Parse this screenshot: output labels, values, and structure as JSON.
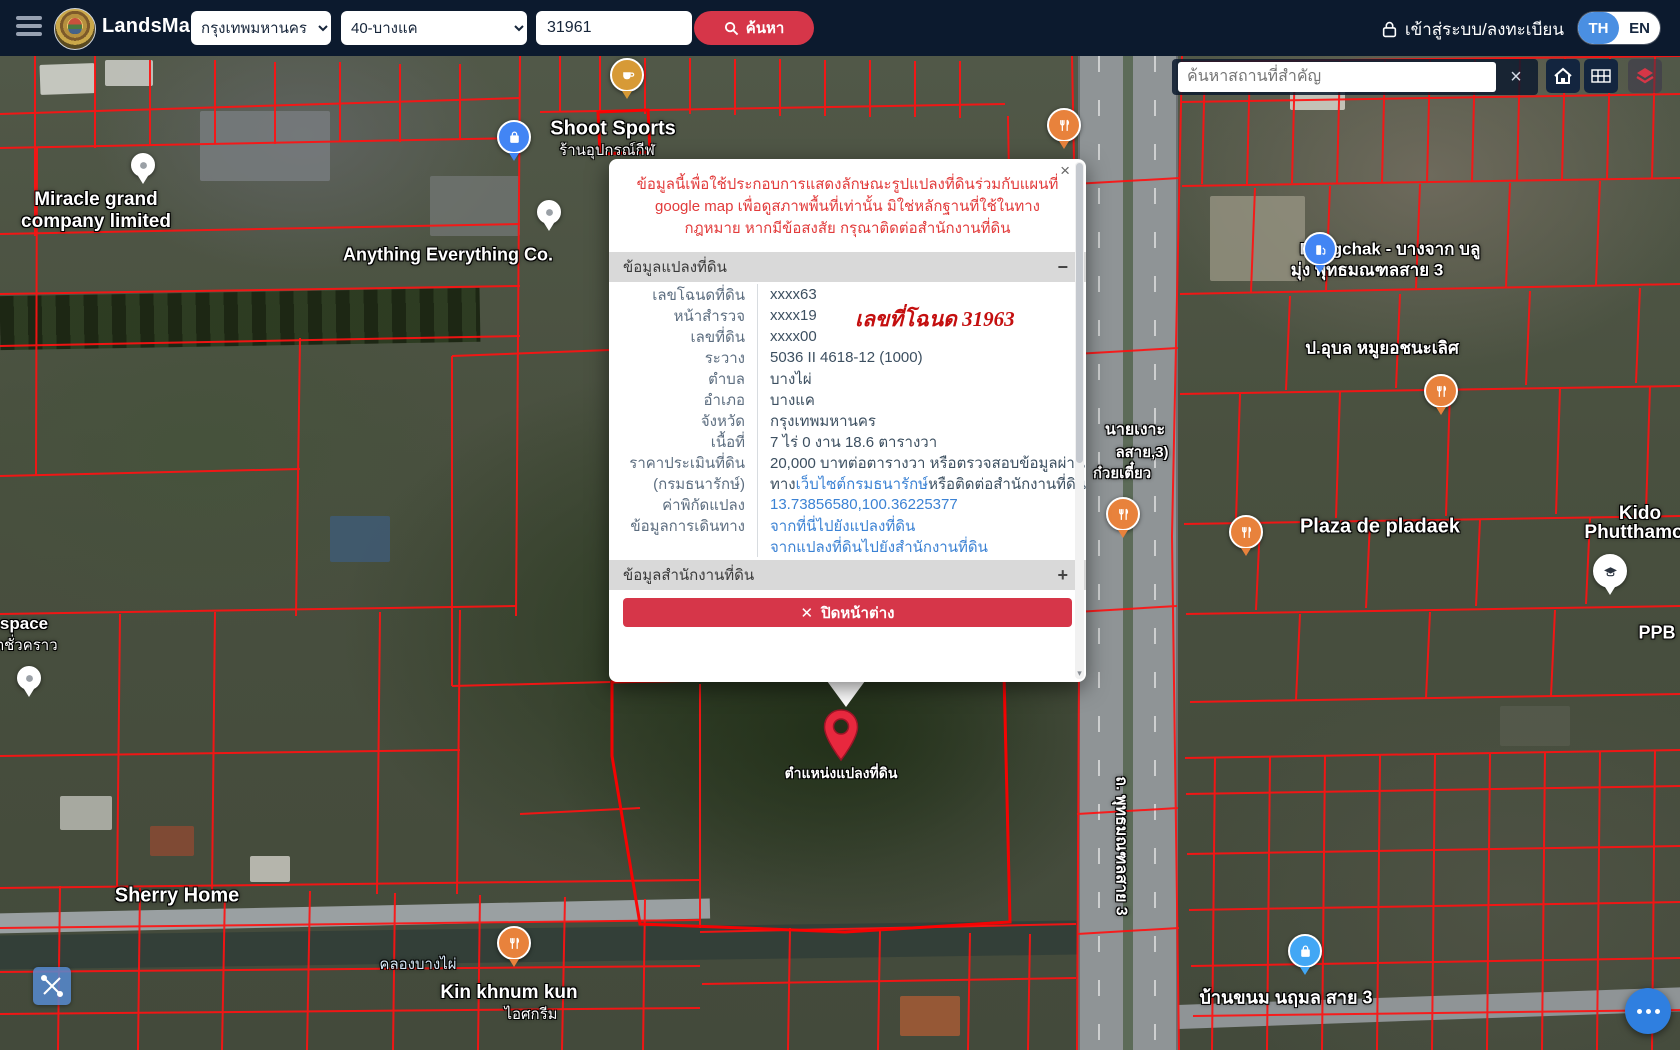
{
  "navbar": {
    "brand": "LandsMaps",
    "province_selected": "กรุงเทพมหานคร",
    "branch_selected": "40-บางแค",
    "parcel_value": "31961",
    "search_label": "ค้นหา",
    "login_label": "เข้าสู่ระบบ/ลงทะเบียน",
    "lang_th": "TH",
    "lang_en": "EN"
  },
  "map_controls": {
    "search_placeholder": "ค้นหาสถานที่สำคัญ",
    "clear_label": "×"
  },
  "popup": {
    "close_glyph": "×",
    "warning": "ข้อมูลนี้เพื่อใช้ประกอบการแสดงลักษณะรูปแปลงที่ดินร่วมกับแผนที่ google map เพื่อดูสภาพพื้นที่เท่านั้น มิใช่หลักฐานที่ใช้ในทางกฎหมาย หากมีข้อสงสัย กรุณาติดต่อสำนักงานที่ดิน",
    "section1_title": "ข้อมูลแปลงที่ดิน",
    "section1_toggle": "−",
    "annotation": "เลขที่โฉนด 31963",
    "rows": [
      {
        "label": "เลขโฉนดที่ดิน",
        "parts": [
          {
            "t": "xxxx63"
          }
        ]
      },
      {
        "label": "หน้าสำรวจ",
        "parts": [
          {
            "t": "xxxx19"
          }
        ]
      },
      {
        "label": "เลขที่ดิน",
        "parts": [
          {
            "t": "xxxx00"
          }
        ]
      },
      {
        "label": "ระวาง",
        "parts": [
          {
            "t": "5036 II 4618-12 (1000)"
          }
        ]
      },
      {
        "label": "ตำบล",
        "parts": [
          {
            "t": "บางไผ่"
          }
        ]
      },
      {
        "label": "อำเภอ",
        "parts": [
          {
            "t": "บางแค"
          }
        ]
      },
      {
        "label": "จังหวัด",
        "parts": [
          {
            "t": "กรุงเทพมหานคร"
          }
        ]
      },
      {
        "label": "เนื้อที่",
        "parts": [
          {
            "t": "7 ไร่ 0 งาน 18.6 ตารางวา"
          }
        ]
      },
      {
        "label": "ราคาประเมินที่ดิน",
        "parts": [
          {
            "t": "20,000 บาทต่อตารางวา หรือตรวจสอบข้อมูลผ่าน"
          }
        ]
      },
      {
        "label": "(กรมธนารักษ์)",
        "parts": [
          {
            "t": "ทาง "
          },
          {
            "t": "เว็บไซต์กรมธนารักษ์",
            "link": true
          },
          {
            "t": " หรือติดต่อสำนักงานที่ดิน"
          }
        ]
      },
      {
        "label": "ค่าพิกัดแปลง",
        "parts": [
          {
            "t": "13.73856580,100.36225377",
            "link": true
          }
        ]
      },
      {
        "label": "ข้อมูลการเดินทาง",
        "parts": [
          {
            "t": "จากที่นี่ไปยังแปลงที่ดิน",
            "link": true
          }
        ]
      },
      {
        "label": "",
        "parts": [
          {
            "t": "จากแปลงที่ดินไปยังสำนักงานที่ดิน",
            "link": true
          }
        ]
      }
    ],
    "section2_title": "ข้อมูลสำนักงานที่ดิน",
    "section2_toggle": "+",
    "close_button_icon": "✕",
    "close_button_label": "ปิดหน้าต่าง"
  },
  "marker": {
    "label": "ตำแหน่งแปลงที่ดิน"
  },
  "map": {
    "labels": [
      {
        "text": "Miracle grand",
        "x": 96,
        "y": 144,
        "s": 19,
        "b": true
      },
      {
        "text": "company limited",
        "x": 96,
        "y": 166,
        "s": 19,
        "b": true
      },
      {
        "text": "Shoot Sports",
        "x": 613,
        "y": 73,
        "s": 20,
        "b": true
      },
      {
        "text": "ร้านอุปกรณ์กีฬ",
        "x": 607,
        "y": 94,
        "s": 15,
        "b": false
      },
      {
        "text": "Anything Everything Co.",
        "x": 448,
        "y": 199,
        "s": 18,
        "b": true
      },
      {
        "text": "Bangchak - บางจาก บลู",
        "x": 1390,
        "y": 193,
        "s": 17,
        "b": true
      },
      {
        "text": "มุ่ง พุทธมณฑลสาย 3",
        "x": 1367,
        "y": 214,
        "s": 17,
        "b": true
      },
      {
        "text": "ป.อุบล หมูยอชนะเลิศ",
        "x": 1382,
        "y": 292,
        "s": 17,
        "b": true
      },
      {
        "text": "Plaza de pladaek",
        "x": 1380,
        "y": 471,
        "s": 20,
        "b": true
      },
      {
        "text": "Kido",
        "x": 1640,
        "y": 458,
        "s": 19,
        "b": true
      },
      {
        "text": "Phutthamo",
        "x": 1634,
        "y": 477,
        "s": 19,
        "b": true
      },
      {
        "text": "PPB",
        "x": 1657,
        "y": 577,
        "s": 18,
        "b": true
      },
      {
        "text": "space",
        "x": 24,
        "y": 568,
        "s": 17,
        "b": true
      },
      {
        "text": "ตชั่วคราว",
        "x": 26,
        "y": 589,
        "s": 15,
        "b": false
      },
      {
        "text": "Sherry Home",
        "x": 177,
        "y": 840,
        "s": 20,
        "b": true
      },
      {
        "text": "คลองบางไผ่",
        "x": 418,
        "y": 908,
        "s": 15,
        "b": false,
        "c": "#d7e9f8"
      },
      {
        "text": "Kin khnum kun",
        "x": 509,
        "y": 937,
        "s": 19,
        "b": true
      },
      {
        "text": "ไอศกรีม",
        "x": 531,
        "y": 958,
        "s": 15,
        "b": false
      },
      {
        "text": "บ้านขนม นฤมล สาย 3",
        "x": 1286,
        "y": 941,
        "s": 18,
        "b": true
      },
      {
        "text": "นายเงาะ",
        "x": 1135,
        "y": 374,
        "s": 16,
        "b": true
      },
      {
        "text": "ลสาย,3)",
        "x": 1142,
        "y": 396,
        "s": 15,
        "b": true
      },
      {
        "text": "ก๋วยเตี๋ยว",
        "x": 1122,
        "y": 417,
        "s": 15,
        "b": true
      },
      {
        "text": "ถ. พุทธมณฑลสาย 3",
        "x": 1121,
        "y": 790,
        "s": 16,
        "b": true,
        "v": true
      }
    ],
    "pins": [
      {
        "type": "coffee",
        "icon": "coffee",
        "x": 627,
        "y": 19,
        "color": "#d79a36"
      },
      {
        "type": "shopping",
        "icon": "bag",
        "x": 514,
        "y": 81,
        "color": "#4285f4"
      },
      {
        "type": "poi",
        "icon": "dot",
        "x": 549,
        "y": 156,
        "color": "#ffffff",
        "small": true
      },
      {
        "type": "poi",
        "icon": "dot",
        "x": 143,
        "y": 109,
        "color": "#ffffff",
        "small": true
      },
      {
        "type": "poi",
        "icon": "dot",
        "x": 29,
        "y": 622,
        "color": "#ffffff",
        "small": true
      },
      {
        "type": "restaurant",
        "icon": "fork",
        "x": 1064,
        "y": 69,
        "color": "#e8823c"
      },
      {
        "type": "restaurant",
        "icon": "fork",
        "x": 1123,
        "y": 458,
        "color": "#e8823c"
      },
      {
        "type": "restaurant",
        "icon": "fork",
        "x": 1246,
        "y": 476,
        "color": "#e8823c"
      },
      {
        "type": "restaurant",
        "icon": "fork",
        "x": 1441,
        "y": 335,
        "color": "#e8823c"
      },
      {
        "type": "restaurant",
        "icon": "fork",
        "x": 514,
        "y": 887,
        "color": "#e8823c"
      },
      {
        "type": "fuel",
        "icon": "fuel",
        "x": 1320,
        "y": 193,
        "color": "#4285f4"
      },
      {
        "type": "school",
        "icon": "grad",
        "x": 1610,
        "y": 515,
        "color": "#ffffff"
      },
      {
        "type": "bakery",
        "icon": "bag",
        "x": 1305,
        "y": 895,
        "color": "#42a7f5"
      }
    ]
  }
}
